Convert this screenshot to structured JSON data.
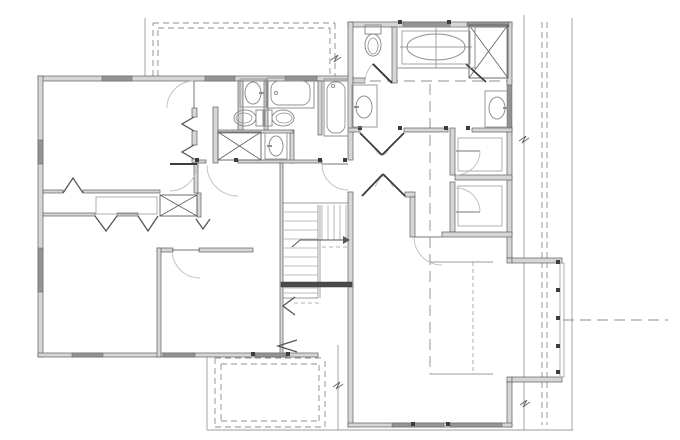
{
  "meta": {
    "title": "second-floor-plan",
    "width": 680,
    "height": 440
  },
  "colors": {
    "bg": "#ffffff",
    "wall_fill": "#d6d6d6",
    "wall_stroke": "#5f5f5f",
    "window_fill": "#949494",
    "dark": "#3c3c3c",
    "light": "#9b9b9b",
    "fixture": "#8f8f8f",
    "arc": "#bdbdbd",
    "dash": "#8c8c8c",
    "tread": "#a8a8a8"
  },
  "walls": [
    [
      38,
      76,
      315,
      5
    ],
    [
      38,
      76,
      5,
      281
    ],
    [
      38,
      353,
      280,
      4
    ],
    [
      192,
      108,
      5,
      9
    ],
    [
      192,
      131,
      5,
      14
    ],
    [
      192,
      159,
      5,
      4
    ],
    [
      213,
      107,
      5,
      56
    ],
    [
      238,
      81,
      5,
      49
    ],
    [
      264,
      81,
      4,
      49
    ],
    [
      318,
      81,
      4,
      54
    ],
    [
      290,
      130,
      4,
      33
    ],
    [
      218,
      130,
      75,
      3
    ],
    [
      43,
      190,
      20,
      3
    ],
    [
      83,
      190,
      77,
      3
    ],
    [
      43,
      213,
      52,
      3
    ],
    [
      117,
      213,
      21,
      3
    ],
    [
      197,
      193,
      4,
      24
    ],
    [
      194,
      163,
      4,
      30
    ],
    [
      197,
      160,
      9,
      3
    ],
    [
      238,
      160,
      84,
      3
    ],
    [
      157,
      248,
      16,
      4
    ],
    [
      199,
      248,
      54,
      4
    ],
    [
      157,
      248,
      4,
      109
    ],
    [
      280,
      163,
      3,
      194
    ],
    [
      348,
      22,
      164,
      5
    ],
    [
      348,
      22,
      5,
      138
    ],
    [
      348,
      192,
      5,
      235
    ],
    [
      507,
      22,
      5,
      63
    ],
    [
      507,
      127,
      5,
      131
    ],
    [
      507,
      258,
      5,
      5
    ],
    [
      512,
      258,
      50,
      5
    ],
    [
      507,
      377,
      5,
      5
    ],
    [
      512,
      377,
      50,
      5
    ],
    [
      507,
      382,
      5,
      45
    ],
    [
      348,
      423,
      164,
      4
    ],
    [
      392,
      27,
      5,
      56
    ],
    [
      353,
      78,
      12,
      5
    ],
    [
      348,
      128,
      12,
      4
    ],
    [
      404,
      128,
      44,
      4
    ],
    [
      472,
      128,
      40,
      4
    ],
    [
      450,
      128,
      5,
      47
    ],
    [
      450,
      182,
      5,
      50
    ],
    [
      455,
      175,
      57,
      5
    ],
    [
      442,
      232,
      70,
      5
    ],
    [
      405,
      192,
      10,
      5
    ],
    [
      410,
      197,
      5,
      40
    ]
  ],
  "windows": [
    [
      102,
      76,
      30,
      5
    ],
    [
      205,
      76,
      30,
      5
    ],
    [
      285,
      76,
      32,
      5
    ],
    [
      38,
      140,
      5,
      24
    ],
    [
      38,
      248,
      5,
      44
    ],
    [
      72,
      353,
      31,
      4
    ],
    [
      163,
      353,
      32,
      4
    ],
    [
      255,
      353,
      32,
      4
    ],
    [
      403,
      22,
      47,
      5
    ],
    [
      467,
      22,
      42,
      5
    ],
    [
      507,
      85,
      5,
      42
    ],
    [
      392,
      423,
      52,
      4
    ],
    [
      450,
      423,
      52,
      4
    ]
  ],
  "light_rects": [
    [
      96,
      197,
      61,
      17
    ],
    [
      458,
      138,
      44,
      33
    ],
    [
      458,
      186,
      44,
      40
    ],
    [
      560,
      263,
      4,
      114
    ]
  ],
  "dark_rects": [
    [
      281,
      282,
      71,
      5
    ]
  ],
  "thin_lines": [
    [
      145,
      18,
      145,
      76
    ],
    [
      524,
      15,
      524,
      430
    ],
    [
      572,
      18,
      572,
      430
    ],
    [
      207,
      430,
      573,
      430
    ],
    [
      207,
      357,
      207,
      430
    ],
    [
      338,
      345,
      338,
      430
    ],
    [
      436,
      27,
      436,
      68
    ],
    [
      400,
      47,
      472,
      47
    ],
    [
      430,
      262,
      493,
      262
    ],
    [
      430,
      374,
      493,
      374
    ],
    [
      283,
      203,
      348,
      203
    ],
    [
      318,
      205,
      318,
      298
    ],
    [
      320,
      205,
      320,
      298
    ],
    [
      283,
      298,
      318,
      298
    ],
    [
      318,
      240,
      348,
      240
    ]
  ],
  "tread_lines": [
    [
      284,
      212,
      318,
      212
    ],
    [
      284,
      221,
      318,
      221
    ],
    [
      284,
      230,
      318,
      230
    ],
    [
      284,
      239,
      318,
      239
    ],
    [
      284,
      248,
      318,
      248
    ],
    [
      284,
      257,
      318,
      257
    ],
    [
      284,
      266,
      318,
      266
    ],
    [
      284,
      275,
      318,
      275
    ],
    [
      284,
      288,
      318,
      288
    ],
    [
      284,
      293,
      318,
      293
    ],
    [
      322,
      205,
      322,
      240
    ],
    [
      328,
      205,
      328,
      240
    ],
    [
      334,
      205,
      334,
      240
    ],
    [
      340,
      205,
      340,
      240
    ],
    [
      346,
      205,
      346,
      240
    ]
  ],
  "dashes": {
    "roof": [
      [
        153,
        76,
        153,
        23
      ],
      [
        153,
        23,
        335,
        23
      ],
      [
        335,
        23,
        335,
        76
      ],
      [
        158,
        76,
        158,
        28
      ],
      [
        158,
        28,
        330,
        28
      ],
      [
        330,
        28,
        330,
        76
      ],
      [
        542,
        22,
        542,
        425
      ],
      [
        547,
        22,
        547,
        425
      ],
      [
        215,
        358,
        215,
        427
      ],
      [
        215,
        427,
        325,
        427
      ],
      [
        325,
        427,
        325,
        358
      ],
      [
        215,
        358,
        325,
        358
      ],
      [
        221,
        364,
        221,
        421
      ],
      [
        221,
        421,
        319,
        421
      ],
      [
        319,
        421,
        319,
        364
      ],
      [
        221,
        364,
        319,
        364
      ]
    ],
    "center": [
      [
        430,
        84,
        430,
        374
      ],
      [
        353,
        81,
        507,
        81
      ],
      [
        563,
        320,
        668,
        320
      ]
    ],
    "light": [
      [
        473,
        262,
        473,
        374
      ],
      [
        322,
        247,
        348,
        247
      ],
      [
        294,
        303,
        322,
        303
      ]
    ]
  },
  "doors": [
    {
      "h": [
        194,
        108
      ],
      "r": 27,
      "a1": -90,
      "a2": -180,
      "leaf": true,
      "dark": false
    },
    {
      "h": [
        170,
        164
      ],
      "r": 27,
      "a1": 0,
      "a2": 90,
      "leaf": true,
      "dark": true
    },
    {
      "h": [
        238,
        165
      ],
      "r": 31,
      "a1": 180,
      "a2": 90,
      "leaf": false,
      "dark": false
    },
    {
      "h": [
        348,
        164
      ],
      "r": 26,
      "a1": 180,
      "a2": 90,
      "leaf": true,
      "dark": false
    },
    {
      "h": [
        200,
        250
      ],
      "r": 28,
      "a1": 180,
      "a2": 90,
      "leaf": true,
      "dark": false
    },
    {
      "h": [
        392,
        83
      ],
      "r": 27,
      "a1": -135,
      "a2": -180,
      "leaf": true,
      "dark": true
    },
    {
      "h": [
        456,
        151
      ],
      "r": 24,
      "a1": 0,
      "a2": 90,
      "leaf": true,
      "dark": false
    },
    {
      "h": [
        456,
        212
      ],
      "r": 24,
      "a1": 0,
      "a2": -90,
      "leaf": true,
      "dark": false
    },
    {
      "h": [
        442,
        237
      ],
      "r": 28,
      "a1": 180,
      "a2": 90,
      "leaf": true,
      "dark": false
    }
  ],
  "door_extra_paths": [
    "M374,147 Q379,157 382,154",
    "M390,147 Q385,157 382,154",
    "M375,187 Q380,177 383,176",
    "M393,187 Q388,177 383,176"
  ],
  "dark_lines": [
    [
      466,
      64,
      486,
      82
    ],
    [
      360,
      133,
      382,
      155
    ],
    [
      404,
      133,
      382,
      155
    ],
    [
      362,
      196,
      383,
      174
    ],
    [
      405,
      196,
      383,
      174
    ]
  ],
  "xboxes": [
    [
      218,
      132,
      43,
      28
    ],
    [
      160,
      195,
      37,
      21
    ],
    [
      469,
      25,
      39,
      53
    ]
  ],
  "chevrons": [
    [
      [
        63,
        193
      ],
      [
        73,
        178
      ],
      [
        83,
        193
      ]
    ],
    [
      [
        95,
        216
      ],
      [
        106,
        231
      ],
      [
        117,
        216
      ]
    ],
    [
      [
        138,
        216
      ],
      [
        148,
        231
      ],
      [
        158,
        216
      ]
    ],
    [
      [
        194,
        117
      ],
      [
        182,
        124
      ],
      [
        194,
        131
      ]
    ],
    [
      [
        194,
        145
      ],
      [
        182,
        152
      ],
      [
        194,
        159
      ]
    ],
    [
      [
        295,
        297
      ],
      [
        283,
        306
      ],
      [
        295,
        315
      ]
    ],
    [
      [
        196,
        219
      ],
      [
        203,
        229
      ],
      [
        210,
        219
      ]
    ],
    [
      [
        297,
        340
      ],
      [
        278,
        346
      ],
      [
        297,
        352
      ]
    ]
  ],
  "jambs": [
    [
      197,
      160
    ],
    [
      236,
      160
    ],
    [
      320,
      160
    ],
    [
      345,
      160
    ],
    [
      360,
      128
    ],
    [
      400,
      128
    ],
    [
      446,
      128
    ],
    [
      468,
      128
    ],
    [
      400,
      22
    ],
    [
      449,
      22
    ],
    [
      413,
      424
    ],
    [
      448,
      424
    ],
    [
      253,
      354
    ],
    [
      288,
      354
    ],
    [
      558,
      262
    ],
    [
      558,
      290
    ],
    [
      558,
      318
    ],
    [
      558,
      346
    ],
    [
      558,
      372
    ]
  ],
  "fixtures": {
    "toilets": [
      {
        "cx": 244,
        "cy": 118,
        "rot": 90
      },
      {
        "cx": 284,
        "cy": 118,
        "rot": -90
      },
      {
        "cx": 373,
        "cy": 46,
        "rot": 0
      }
    ],
    "sinks": [
      {
        "cx": 253,
        "cy": 93,
        "rx": 8,
        "ry": 11,
        "f": "e"
      },
      {
        "cx": 276,
        "cy": 146,
        "rx": 7,
        "ry": 10,
        "f": "w"
      },
      {
        "cx": 364,
        "cy": 107,
        "rx": 8,
        "ry": 11,
        "f": "w"
      },
      {
        "cx": 497,
        "cy": 108,
        "rx": 8,
        "ry": 11,
        "f": "e"
      }
    ],
    "vanities": [
      [
        240,
        79,
        26,
        28
      ],
      [
        265,
        133,
        22,
        26
      ],
      [
        352,
        85,
        25,
        42
      ],
      [
        485,
        91,
        25,
        36
      ]
    ],
    "tubs": [
      {
        "o": [
          267,
          78,
          47,
          30
        ],
        "i": [
          271,
          81,
          39,
          24
        ],
        "f": [
          276,
          93
        ]
      },
      {
        "o": [
          324,
          79,
          24,
          57
        ],
        "i": [
          327,
          82,
          18,
          51
        ],
        "f": [
          333,
          86
        ]
      }
    ],
    "garden_tub": {
      "plat": [
        397,
        27,
        78,
        41
      ],
      "inner": [
        402,
        31,
        68,
        33
      ],
      "cx": 436,
      "cy": 47,
      "rx": 29,
      "ry": 13
    }
  },
  "arrow": {
    "line": [
      [
        292,
        247
      ],
      [
        300,
        240
      ],
      [
        343,
        240
      ]
    ],
    "head": [
      [
        343,
        236
      ],
      [
        350,
        240
      ],
      [
        343,
        244
      ]
    ]
  },
  "breaks": [
    [
      [
        519,
        141
      ],
      [
        526,
        136
      ],
      [
        522,
        143
      ],
      [
        529,
        138
      ]
    ],
    [
      [
        520,
        405
      ],
      [
        527,
        400
      ],
      [
        523,
        407
      ],
      [
        530,
        402
      ]
    ],
    [
      [
        333,
        387
      ],
      [
        340,
        382
      ],
      [
        336,
        389
      ],
      [
        343,
        384
      ]
    ],
    [
      [
        331,
        60
      ],
      [
        338,
        55
      ],
      [
        334,
        62
      ],
      [
        341,
        57
      ]
    ]
  ]
}
